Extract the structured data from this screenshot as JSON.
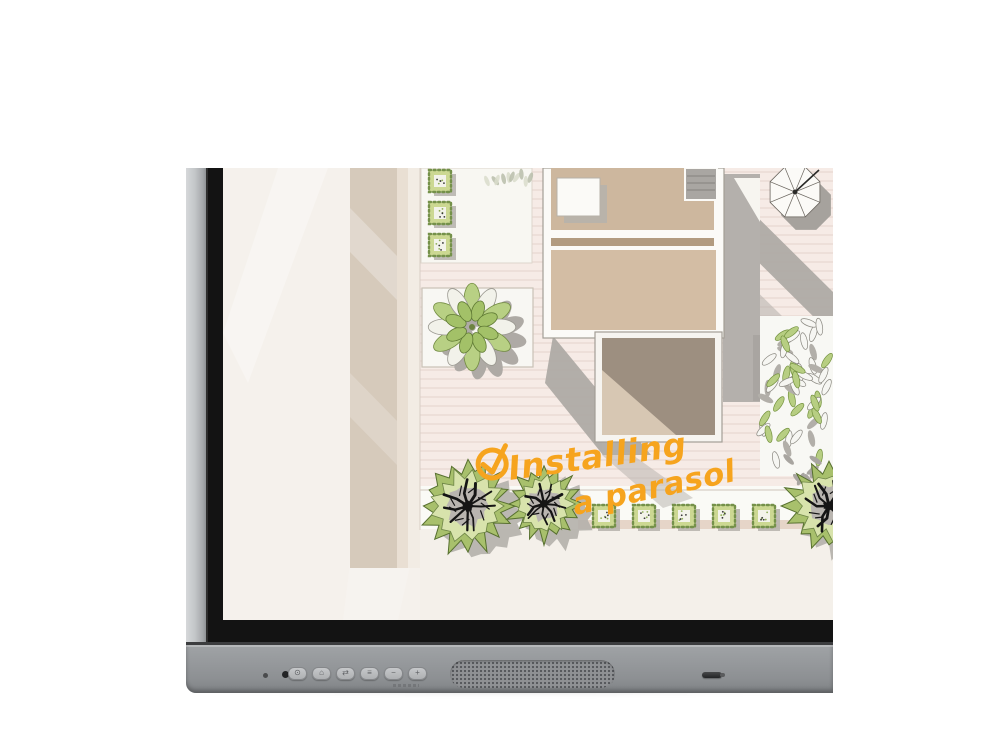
{
  "device": {
    "name": "interactive-flat-panel-display",
    "annotation": {
      "icon": "check-circle-icon",
      "line1": "Installing",
      "line2": "a parasol",
      "color": "#F6A41E"
    },
    "buttons": [
      {
        "name": "power-button",
        "glyph": "⊙"
      },
      {
        "name": "home-button",
        "glyph": "⌂"
      },
      {
        "name": "input-select-button",
        "glyph": "⇄"
      },
      {
        "name": "menu-button",
        "glyph": "≡"
      },
      {
        "name": "volume-down-button",
        "glyph": "−"
      },
      {
        "name": "volume-up-button",
        "glyph": "+"
      }
    ],
    "indicators": [
      "ambient-light-sensor",
      "status-led"
    ],
    "speaker": "speaker-grille",
    "pen_tray": "stylus"
  },
  "screen_content": {
    "subject": "garden-landscape-plan",
    "elements": [
      "house-rooms",
      "parasol-top-view",
      "agave-star-plant",
      "box-hedges",
      "round-bushes",
      "leaf-foliage",
      "wood-deck",
      "handwritten-annotation"
    ]
  },
  "colors": {
    "annotation_orange": "#F6A41E",
    "bezel_black": "#131313",
    "frame_silver": "#9B9EA1",
    "screen_cream": "#F5F1EC",
    "deck_pink": "#F6EBE6",
    "room_tan": "#CDB79E",
    "room_dark_taupe": "#9D8F80",
    "plant_green": "#AECB7A",
    "shadow_gray": "#ABA7A2"
  }
}
